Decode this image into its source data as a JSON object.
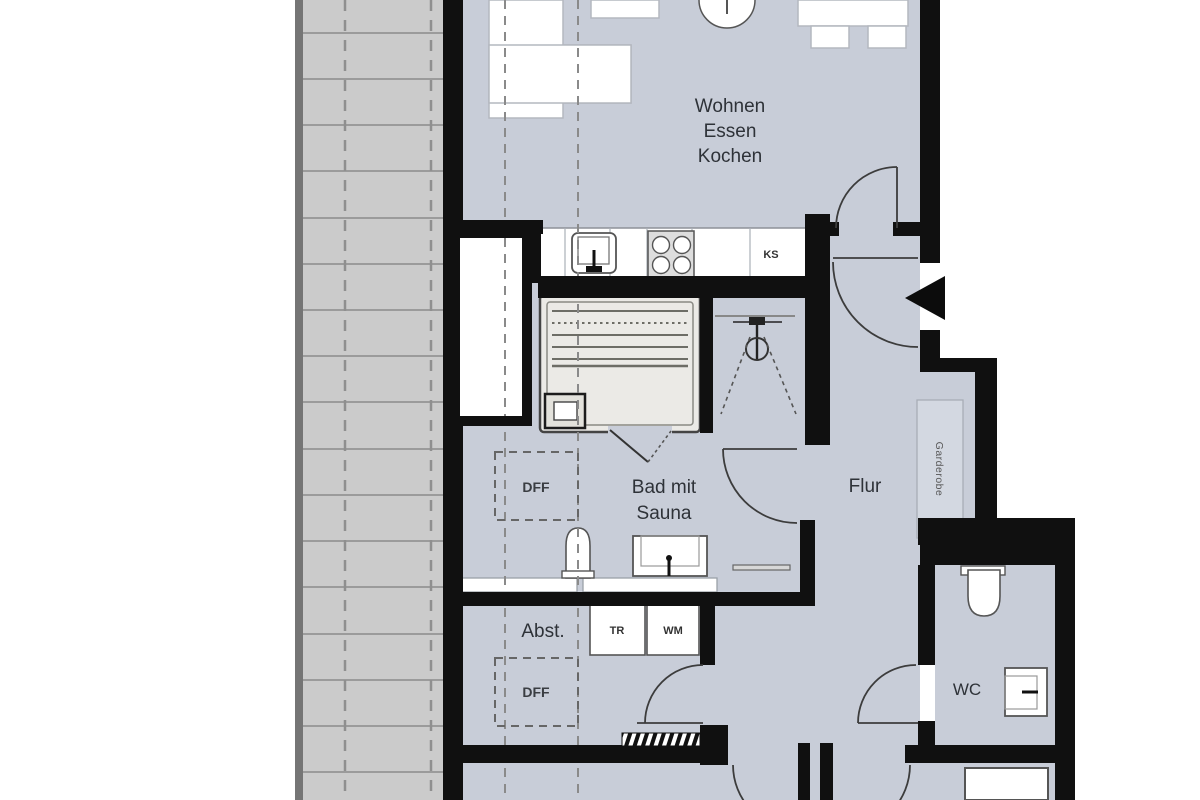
{
  "floor_plan": {
    "rooms": {
      "living": {
        "line1": "Wohnen",
        "line2": "Essen",
        "line3": "Kochen"
      },
      "bath": {
        "line1": "Bad mit",
        "line2": "Sauna"
      },
      "hall": {
        "label": "Flur"
      },
      "storage": {
        "label": "Abst."
      },
      "wc": {
        "label": "WC"
      }
    },
    "appliances": {
      "fridge": "KS",
      "dryer": "TR",
      "washer": "WM"
    },
    "features": {
      "wardrobe": "Garderobe",
      "roof_window_bath": "DFF",
      "roof_window_storage": "DFF"
    },
    "colors": {
      "floor": "#c8cdd8",
      "terrace": "#cbcbcb",
      "wall": "#101010",
      "sauna": "#ebeae6",
      "fixture": "#ffffff"
    }
  }
}
